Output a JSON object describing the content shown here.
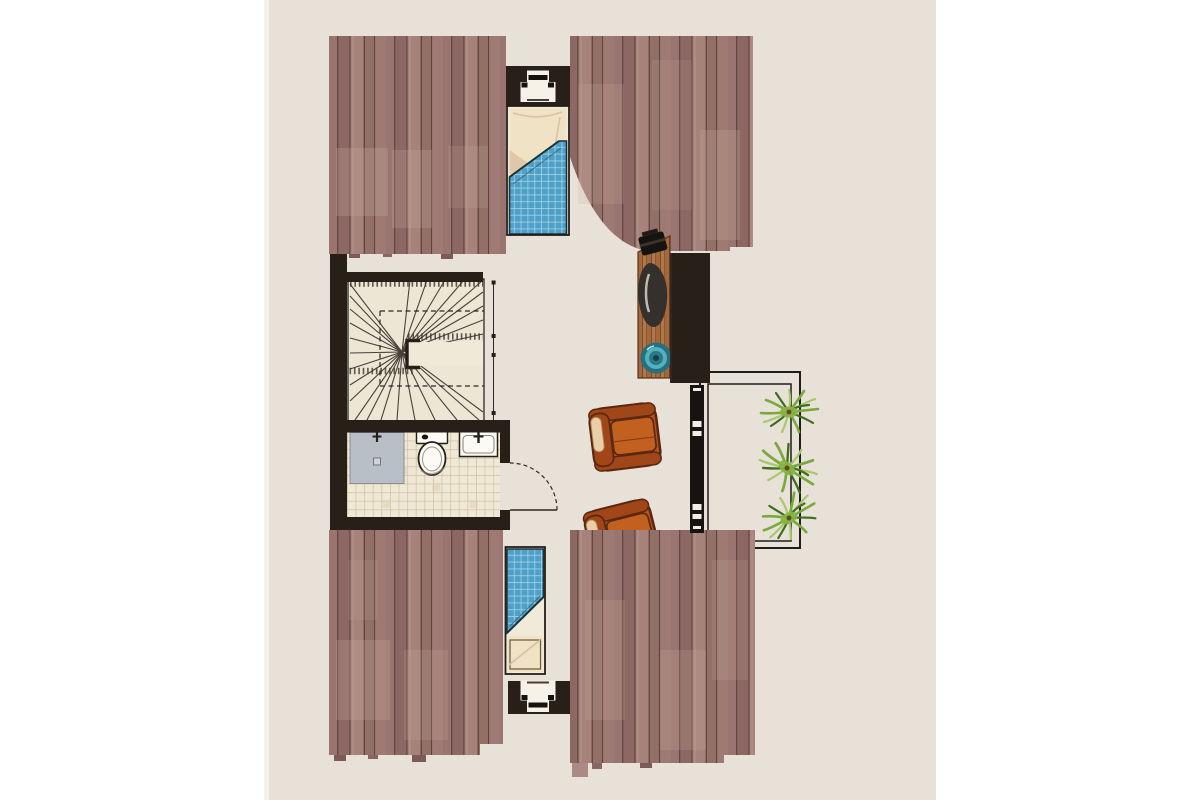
{
  "scene": {
    "kind": "architectural-floor-plan",
    "page_bg": "#ffffff",
    "panel": {
      "x": 264,
      "width": 672,
      "bg": "#e8e1d8",
      "edge_strip": "#f7f2e8"
    }
  },
  "palette": {
    "wall": "#281f18",
    "plank_a": "#9a7470",
    "plank_b": "#8c6763",
    "plank_c": "#a7827b",
    "plank_d": "#927068",
    "plank_e": "#9f7a74",
    "plank_gap": "#654642",
    "plank_patch": "#c7ab9d",
    "stair_floor": "#ece6d4",
    "stair_line": "#35302a",
    "tile_floor": "#efe8d4",
    "tile_line": "#c9b69b",
    "shower_tray": "#b9bfc7",
    "porcelain": "#fbfaf5",
    "outline": "#241f19",
    "sheet": "#f2ead8",
    "pillow": "#f0e2c5",
    "pillow_shade": "#d9bf9c",
    "blanket": "#4fa0c8",
    "blanket_grid": "#a9d6e8",
    "blanket_outline": "#1b343c",
    "desk": "#a2683e",
    "desk_grain": "#7c4b28",
    "laptop": "#17130e",
    "desk_chair": "#34302b",
    "pouf_dark": "#256f7e",
    "pouf_mid": "#52b1bd",
    "pouf_core": "#12424d",
    "armchair": "#b5521f",
    "armchair_dark": "#a04618",
    "armchair_seat": "#c2611f",
    "armchair_trim": "#e9cfa9",
    "armchair_outline": "#5a2810",
    "balcony_line": "#1d1d1b",
    "window_bar": "#171310",
    "plant_dark": "#3f6e1f",
    "plant_mid": "#7aa93c",
    "plant_light": "#a8c96b",
    "plant_core": "#86b445",
    "plant_pot": "#6b431f"
  },
  "rooms": [
    {
      "id": "bedroom-north",
      "items": [
        "single-bed",
        "plaid-blanket",
        "pillow",
        "skylight-window",
        "roof-slope-left",
        "roof-slope-right"
      ]
    },
    {
      "id": "stair-hall",
      "items": [
        "winder-staircase",
        "floor-opening-dashed",
        "section-marker-line"
      ]
    },
    {
      "id": "bathroom",
      "items": [
        "shower-tray",
        "toilet",
        "washbasin",
        "door-swing",
        "tiled-floor"
      ]
    },
    {
      "id": "studio",
      "items": [
        "desk",
        "laptop",
        "desk-chair",
        "round-pouf",
        "wardrobe",
        "armchair",
        "armchair"
      ]
    },
    {
      "id": "balcony",
      "items": [
        "railing-outer",
        "railing-inner",
        "french-window",
        "potted-plant",
        "potted-plant",
        "potted-plant"
      ]
    },
    {
      "id": "bedroom-south",
      "items": [
        "single-bed",
        "plaid-blanket",
        "pillow",
        "skylight-window",
        "roof-slope-left",
        "roof-slope-right"
      ]
    }
  ]
}
